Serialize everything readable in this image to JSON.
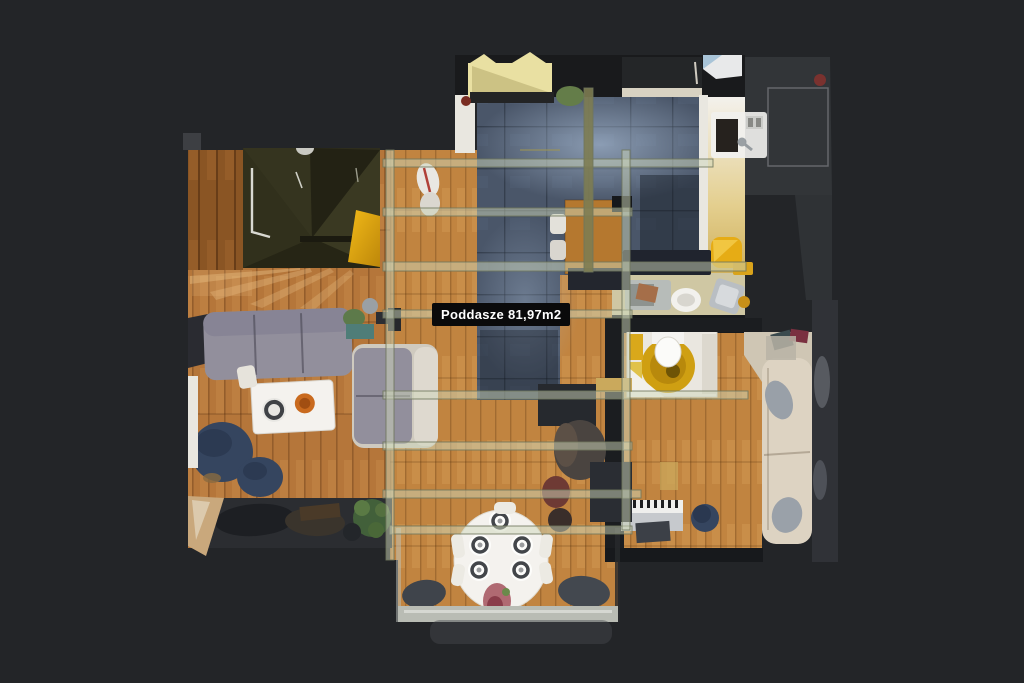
{
  "scene": {
    "floor_label": "Poddasze 81,97m2"
  },
  "palette": {
    "background": "#232528",
    "label_bg": "#0a0a0b",
    "label_text": "#ffffff",
    "wood": "#b5763a",
    "wood_dark": "#8a5524",
    "wood_light": "#c18440",
    "tile": "#4a5669",
    "tile_fog": "#9db1cc",
    "glass": "#cdd4ba",
    "beam_olive": "#7d7c52",
    "wall_white": "#e9e7e0",
    "wall_dark": "#17191c",
    "stair_dark": "#2e2d1d",
    "accent_yellow": "#e6ac15",
    "sofa_yellow": "#e9e0a2",
    "sofa_gray": "#928f9c",
    "sofa_cream": "#ddd3c2",
    "pouf_navy": "#35455f",
    "plant_green": "#4f6b3a",
    "table_white": "#f4f2ee",
    "bowl_orange": "#c96a1e",
    "bath_floor": "#cfc7a3"
  }
}
